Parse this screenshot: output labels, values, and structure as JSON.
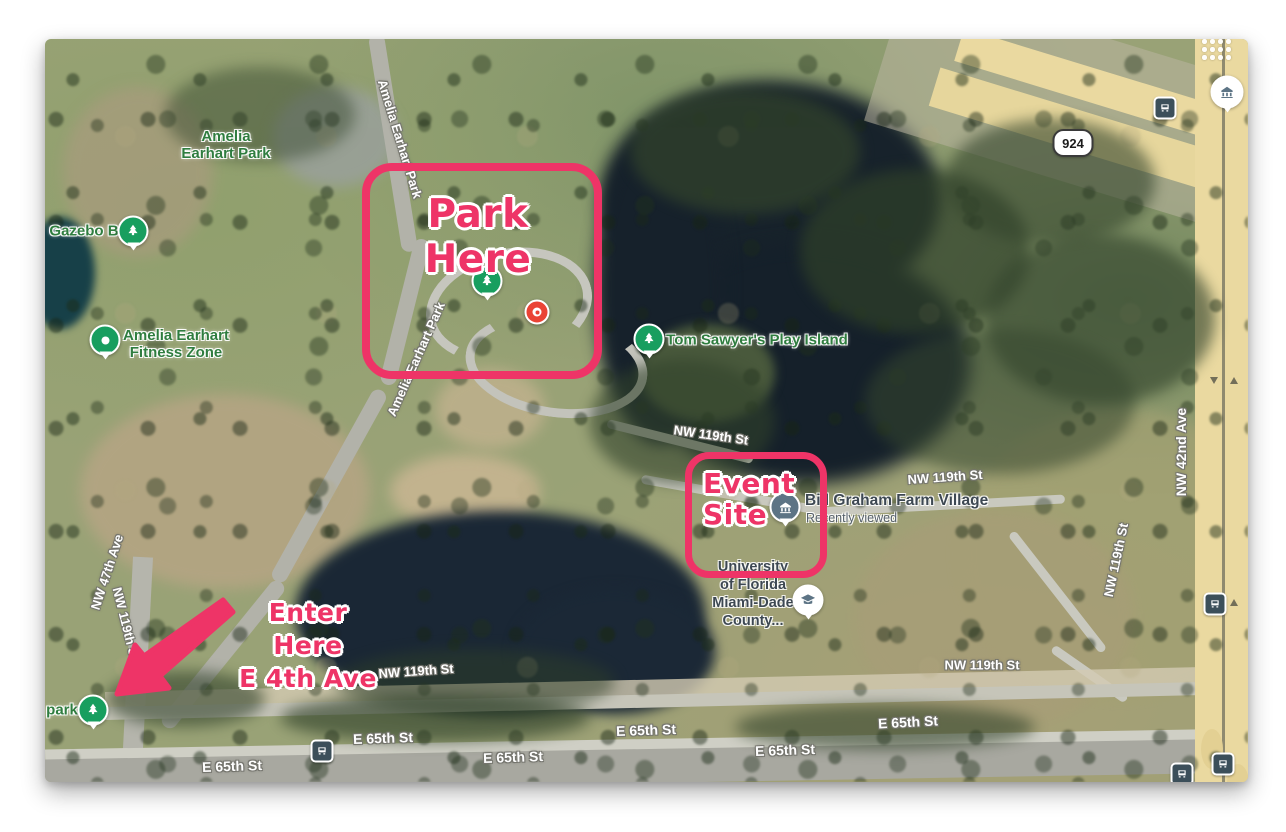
{
  "colors": {
    "annotation_pink": "#ee3467",
    "pin_green": "#189e5f",
    "park_label_green": "#2f7d3f",
    "water": "#1a2735",
    "highway_yellow": "#ead9a0"
  },
  "annotations": {
    "park_here": "Park Here",
    "event_site_line1": "Event",
    "event_site_line2": "Site",
    "enter_here_line1": "Enter Here",
    "enter_here_line2": "E 4th Ave"
  },
  "park_labels": {
    "amelia_line1": "Amelia",
    "amelia_line2": "Earhart Park",
    "gazebo": "Gazebo B",
    "fitness_line1": "Amelia Earhart",
    "fitness_line2": "Fitness Zone",
    "tom_sawyer": "Tom Sawyer's Play Island",
    "park_partial": "park"
  },
  "places": {
    "farm_village": "Bill Graham Farm Village",
    "farm_village_sub": "Recently viewed",
    "university_line1": "University",
    "university_line2": "of Florida",
    "university_line3": "Miami-Dade",
    "university_line4": "County..."
  },
  "road_labels": [
    {
      "text": "Amelia Earhart Park"
    },
    {
      "text": "Amelia Earhart Park"
    },
    {
      "text": "NW 119th St"
    },
    {
      "text": "NW 119th St"
    },
    {
      "text": "NW 119th St"
    },
    {
      "text": "NW 119th St"
    },
    {
      "text": "NW 119th St"
    },
    {
      "text": "NW 47th Ave"
    },
    {
      "text": "NW 119th St"
    },
    {
      "text": "NW 42nd Ave"
    },
    {
      "text": "E 65th St"
    },
    {
      "text": "E 65th St"
    },
    {
      "text": "E 65th St"
    },
    {
      "text": "E 65th St"
    },
    {
      "text": "E 65th St"
    },
    {
      "text": "E 65th St"
    }
  ],
  "route_shield": "924",
  "markers": {
    "tree_pin": "park-tree-pin",
    "fitness_pin": "fitness-zone-pin",
    "red_dot": "red-location-marker",
    "farm_pin": "farm-village-pin",
    "university_pin": "university-pin",
    "bus": "bus-stop-icon"
  }
}
